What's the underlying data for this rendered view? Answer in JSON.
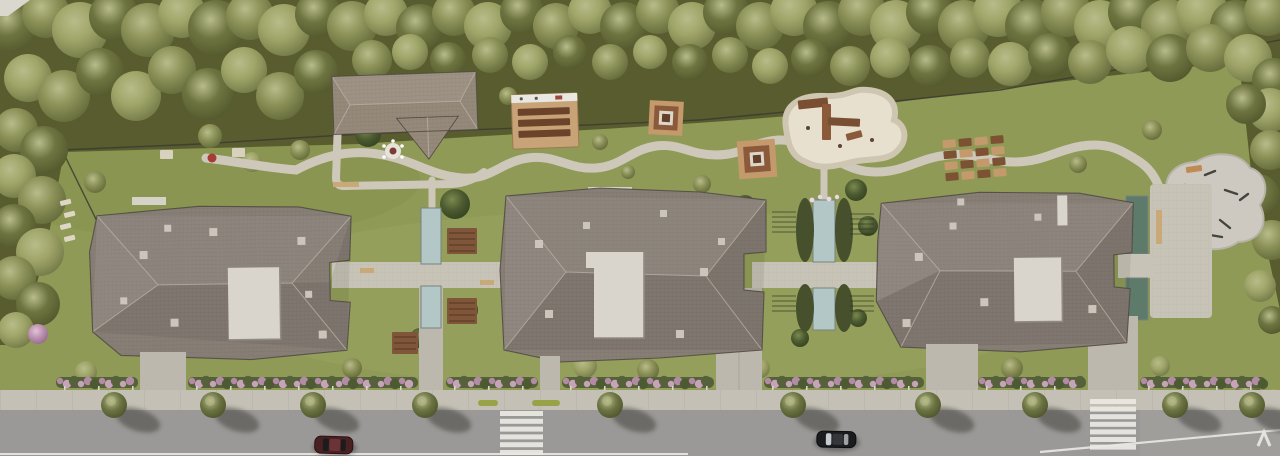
{
  "meta": {
    "title": "Aerial site plan rendering",
    "description": "Top-down 3D architectural rendering of a residential complex: three large apartment buildings with grey tiled hip roofs, lawns, a forest belt along the top, courtyards with water channels and pergolas, a playground, outdoor fitness pad, flowering hedges, a sidewalk with street trees, and an asphalt road with two zebra crosswalks and two parked cars"
  },
  "palette": {
    "lawn": "#8f9a57",
    "lawn_light": "#a2ac69",
    "lawn_dark": "#76823f",
    "forest_floor": "#585c2e",
    "tree0": "#6e7440",
    "tree1": "#8b9157",
    "tree2": "#9fa568",
    "tree3": "#4c5a30",
    "tree4": "#b98fae",
    "tree_street": "#6b7342",
    "tree_hl": "#b7bc8a",
    "roof": "#877e76",
    "roof_light": "#9b9189",
    "roof_dark": "#6f6660",
    "roof_ridge": "#b5aba1",
    "roof_edge": "#4e4842",
    "roof_club": "#95897a",
    "terrace": "#d9d5cd",
    "vent": "#cbc5bc",
    "path": "#cdc8ba",
    "paving": "#c7c3b6",
    "driveway": "#bcb8ad",
    "sidewalk": "#c4c0b5",
    "road": "#9b9997",
    "road_line": "#ebe9e4",
    "water_light": "#b4c7c7",
    "water_dark": "#5e7a6b",
    "water_edge": "#78837f",
    "pergola": "#80563a",
    "pergola_slat": "#55371f",
    "deck": "#c8a377",
    "bench": "#6b432b",
    "sand": "#e7e0cf",
    "equip": "#7a4e33",
    "equip2": "#8a5a3a",
    "pad": "#cdc9c0",
    "box1": "#c49a6c",
    "box2": "#7d5233",
    "hedge": "#55613a",
    "pink1": "#b78dab",
    "pink2": "#cda6c0",
    "fence": "#3b3b31",
    "post": "#d9d6cc",
    "car_maroon": "#4b2023",
    "car_black": "#1b1c1f",
    "car_glass": "#c9ccce",
    "shadow": "#3d3d38"
  },
  "scene": {
    "trees": [
      [
        12,
        26,
        26,
        0
      ],
      [
        46,
        14,
        24,
        1
      ],
      [
        80,
        30,
        28,
        2
      ],
      [
        114,
        16,
        25,
        0
      ],
      [
        148,
        30,
        27,
        1
      ],
      [
        182,
        14,
        24,
        2
      ],
      [
        216,
        28,
        28,
        0
      ],
      [
        250,
        16,
        24,
        1
      ],
      [
        284,
        30,
        26,
        2
      ],
      [
        318,
        14,
        23,
        0
      ],
      [
        352,
        26,
        25,
        1
      ],
      [
        386,
        14,
        22,
        2
      ],
      [
        420,
        28,
        24,
        0
      ],
      [
        454,
        14,
        22,
        1
      ],
      [
        488,
        26,
        24,
        2
      ],
      [
        522,
        12,
        22,
        0
      ],
      [
        556,
        26,
        23,
        1
      ],
      [
        590,
        12,
        22,
        2
      ],
      [
        624,
        26,
        24,
        0
      ],
      [
        658,
        12,
        22,
        1
      ],
      [
        692,
        26,
        24,
        2
      ],
      [
        726,
        12,
        23,
        0
      ],
      [
        760,
        26,
        24,
        1
      ],
      [
        794,
        12,
        24,
        2
      ],
      [
        828,
        26,
        25,
        0
      ],
      [
        862,
        12,
        24,
        1
      ],
      [
        896,
        26,
        26,
        2
      ],
      [
        930,
        12,
        24,
        0
      ],
      [
        964,
        26,
        26,
        1
      ],
      [
        998,
        12,
        25,
        2
      ],
      [
        1032,
        26,
        27,
        0
      ],
      [
        1066,
        12,
        25,
        1
      ],
      [
        1100,
        26,
        26,
        2
      ],
      [
        1134,
        12,
        26,
        0
      ],
      [
        1168,
        26,
        27,
        1
      ],
      [
        1202,
        12,
        26,
        2
      ],
      [
        1236,
        26,
        26,
        0
      ],
      [
        1268,
        12,
        24,
        1
      ],
      [
        28,
        78,
        24,
        2
      ],
      [
        64,
        96,
        26,
        1
      ],
      [
        100,
        72,
        24,
        0
      ],
      [
        136,
        96,
        25,
        2
      ],
      [
        172,
        70,
        24,
        1
      ],
      [
        208,
        94,
        26,
        0
      ],
      [
        244,
        70,
        23,
        2
      ],
      [
        280,
        96,
        24,
        1
      ],
      [
        316,
        72,
        22,
        0
      ],
      [
        372,
        60,
        20,
        1
      ],
      [
        410,
        52,
        18,
        2
      ],
      [
        448,
        60,
        18,
        0
      ],
      [
        490,
        55,
        18,
        1
      ],
      [
        530,
        62,
        18,
        2
      ],
      [
        570,
        52,
        17,
        0
      ],
      [
        610,
        62,
        18,
        1
      ],
      [
        650,
        52,
        17,
        2
      ],
      [
        690,
        62,
        18,
        0
      ],
      [
        730,
        55,
        18,
        1
      ],
      [
        770,
        66,
        18,
        2
      ],
      [
        810,
        58,
        19,
        0
      ],
      [
        850,
        66,
        20,
        1
      ],
      [
        890,
        58,
        20,
        2
      ],
      [
        930,
        66,
        21,
        0
      ],
      [
        970,
        58,
        20,
        1
      ],
      [
        1010,
        64,
        22,
        2
      ],
      [
        1050,
        55,
        22,
        0
      ],
      [
        1090,
        62,
        22,
        1
      ],
      [
        1130,
        50,
        24,
        2
      ],
      [
        1170,
        58,
        24,
        0
      ],
      [
        1210,
        48,
        24,
        1
      ],
      [
        1248,
        58,
        24,
        2
      ],
      [
        1274,
        80,
        22,
        0
      ],
      [
        16,
        130,
        22,
        1
      ],
      [
        44,
        150,
        24,
        0
      ],
      [
        14,
        176,
        22,
        2
      ],
      [
        42,
        200,
        24,
        1
      ],
      [
        14,
        226,
        22,
        0
      ],
      [
        40,
        252,
        24,
        2
      ],
      [
        14,
        278,
        22,
        1
      ],
      [
        38,
        304,
        22,
        0
      ],
      [
        16,
        330,
        18,
        2
      ],
      [
        1270,
        110,
        22,
        2
      ],
      [
        1246,
        104,
        20,
        0
      ],
      [
        1270,
        150,
        20,
        1
      ],
      [
        1258,
        196,
        22,
        0
      ],
      [
        1272,
        240,
        20,
        1
      ],
      [
        1260,
        286,
        16,
        2
      ],
      [
        1272,
        320,
        14,
        0
      ],
      [
        1248,
        394,
        13,
        0
      ],
      [
        1274,
        400,
        11,
        2
      ],
      [
        368,
        134,
        13,
        3
      ],
      [
        300,
        150,
        10,
        1
      ],
      [
        210,
        136,
        12,
        1
      ],
      [
        252,
        162,
        10,
        2
      ],
      [
        95,
        182,
        11,
        1
      ],
      [
        455,
        204,
        15,
        3
      ],
      [
        466,
        310,
        12,
        3
      ],
      [
        420,
        338,
        10,
        3
      ],
      [
        508,
        96,
        9,
        1
      ],
      [
        600,
        142,
        8,
        1
      ],
      [
        628,
        172,
        7,
        1
      ],
      [
        702,
        184,
        9,
        1
      ],
      [
        745,
        206,
        11,
        3
      ],
      [
        856,
        190,
        11,
        3
      ],
      [
        868,
        226,
        10,
        3
      ],
      [
        800,
        338,
        9,
        3
      ],
      [
        858,
        318,
        9,
        3
      ],
      [
        1078,
        164,
        9,
        1
      ],
      [
        1106,
        228,
        11,
        3
      ],
      [
        1152,
        130,
        10,
        1
      ],
      [
        585,
        366,
        12,
        2
      ],
      [
        648,
        370,
        11,
        1
      ],
      [
        760,
        368,
        10,
        2
      ],
      [
        1012,
        368,
        11,
        1
      ],
      [
        1160,
        366,
        10,
        2
      ],
      [
        352,
        368,
        10,
        1
      ],
      [
        86,
        372,
        11,
        2
      ],
      [
        38,
        334,
        10,
        4
      ]
    ],
    "hedge_segments": [
      [
        56,
        138
      ],
      [
        188,
        418
      ],
      [
        446,
        538
      ],
      [
        562,
        714
      ],
      [
        764,
        924
      ],
      [
        978,
        1086
      ],
      [
        1140,
        1266
      ]
    ],
    "street_trees_x": [
      114,
      213,
      313,
      425,
      610,
      793,
      928,
      1035,
      1175,
      1252
    ],
    "crosswalks": [
      {
        "x": 500,
        "y": 411,
        "w": 43,
        "h": 5,
        "gap": 2.8,
        "count": 6
      },
      {
        "x": 1090,
        "y": 399,
        "w": 46,
        "h": 5,
        "gap": 2.6,
        "count": 7
      }
    ],
    "sidewalk_strips": [
      [
        478,
        20
      ],
      [
        532,
        28
      ]
    ]
  }
}
